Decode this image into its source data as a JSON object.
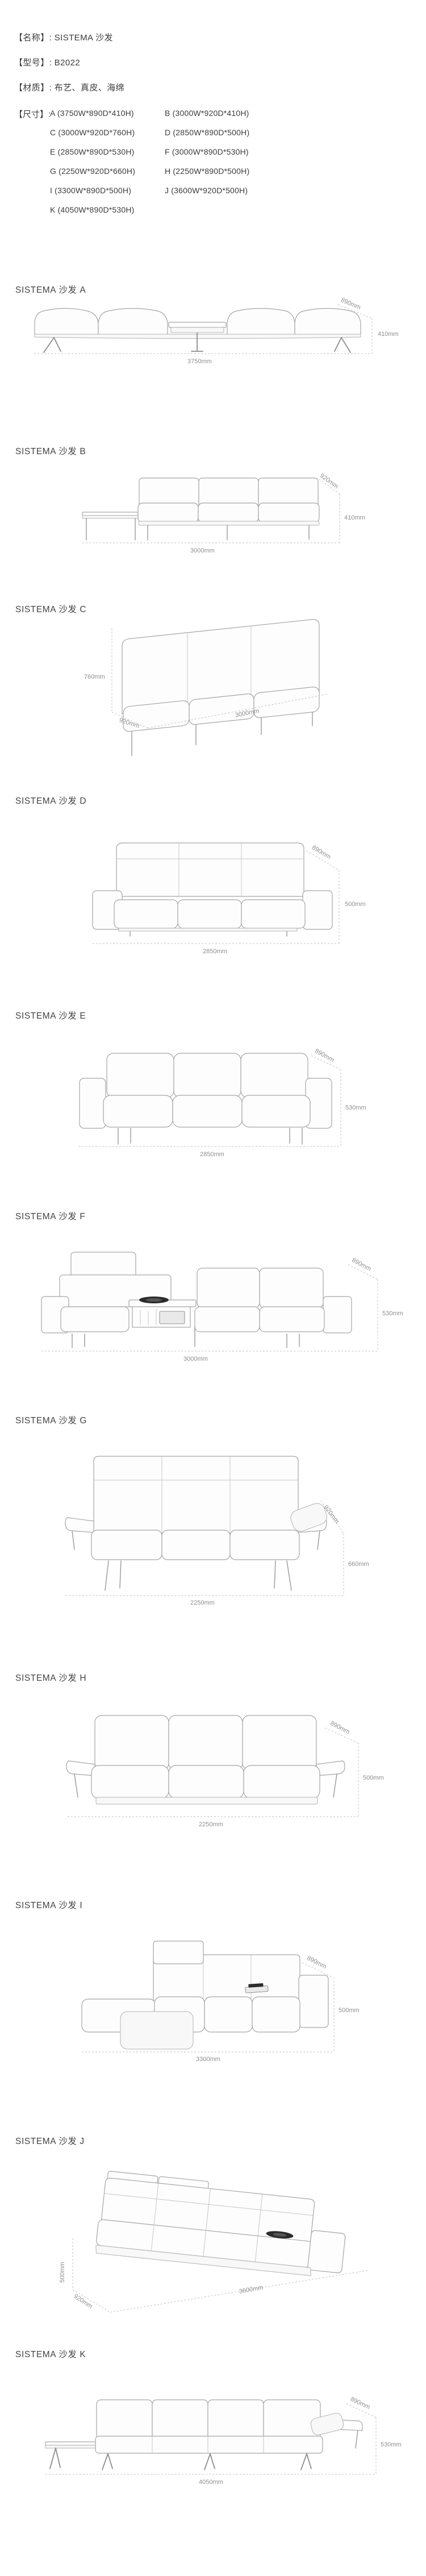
{
  "header": {
    "lines": [
      {
        "text": "【名称】: SISTEMA 沙发"
      },
      {
        "text": "【型号】: B2022"
      },
      {
        "text": "【材质】: 布艺、真皮、海绵"
      }
    ],
    "size_label": "【尺寸】:",
    "size_col1": [
      "A (3750W*890D*410H)",
      "C (3000W*920D*760H)",
      "E (2850W*890D*530H)",
      "G (2250W*920D*660H)",
      "I (3300W*890D*500H)",
      "K (4050W*890D*530H)"
    ],
    "size_col2": [
      "B (3000W*920D*410H)",
      "D (2850W*890D*500H)",
      "F (3000W*890D*530H)",
      "H (2250W*890D*500H)",
      "J (3600W*920D*500H)"
    ]
  },
  "sections": [
    {
      "letter": "A",
      "title": "SISTEMA 沙发 A",
      "width": "3750mm",
      "depth": "890mm",
      "height": "410mm"
    },
    {
      "letter": "B",
      "title": "SISTEMA 沙发 B",
      "width": "3000mm",
      "depth": "920mm",
      "height": "410mm"
    },
    {
      "letter": "C",
      "title": "SISTEMA 沙发 C",
      "width": "3000mm",
      "depth": "920mm",
      "height": "760mm"
    },
    {
      "letter": "D",
      "title": "SISTEMA 沙发 D",
      "width": "2850mm",
      "depth": "890mm",
      "height": "500mm"
    },
    {
      "letter": "E",
      "title": "SISTEMA 沙发 E",
      "width": "2850mm",
      "depth": "890mm",
      "height": "530mm"
    },
    {
      "letter": "F",
      "title": "SISTEMA 沙发 F",
      "width": "3000mm",
      "depth": "890mm",
      "height": "530mm"
    },
    {
      "letter": "G",
      "title": "SISTEMA 沙发 G",
      "width": "2250mm",
      "depth": "920mm",
      "height": "660mm"
    },
    {
      "letter": "H",
      "title": "SISTEMA 沙发 H",
      "width": "2250mm",
      "depth": "890mm",
      "height": "500mm"
    },
    {
      "letter": "I",
      "title": "SISTEMA 沙发 I",
      "width": "3300mm",
      "depth": "890mm",
      "height": "500mm"
    },
    {
      "letter": "J",
      "title": "SISTEMA 沙发 J",
      "width": "3600mm",
      "depth": "920mm",
      "height": "500mm"
    },
    {
      "letter": "K",
      "title": "SISTEMA 沙发 K",
      "width": "4050mm",
      "depth": "890mm",
      "height": "530mm"
    }
  ],
  "colors": {
    "text": "#3d3d3d",
    "dim_label": "#8f8f8f",
    "line_art": "#a6a6a6",
    "dash": "#c2c2c2"
  }
}
